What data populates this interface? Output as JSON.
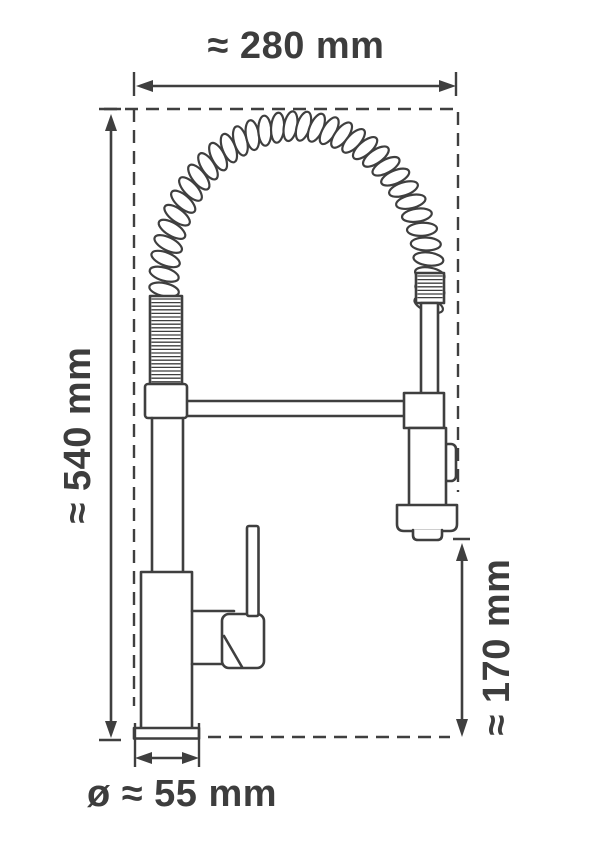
{
  "diagram": {
    "labels": {
      "overall_width": "≈ 280 mm",
      "overall_height": "≈ 540 mm",
      "spray_head_clearance": "≈ 170 mm",
      "base_diameter": "ø ≈ 55 mm"
    },
    "colors": {
      "line": "#3f3f3f",
      "text": "#3d3d3d",
      "background": "#ffffff"
    }
  }
}
